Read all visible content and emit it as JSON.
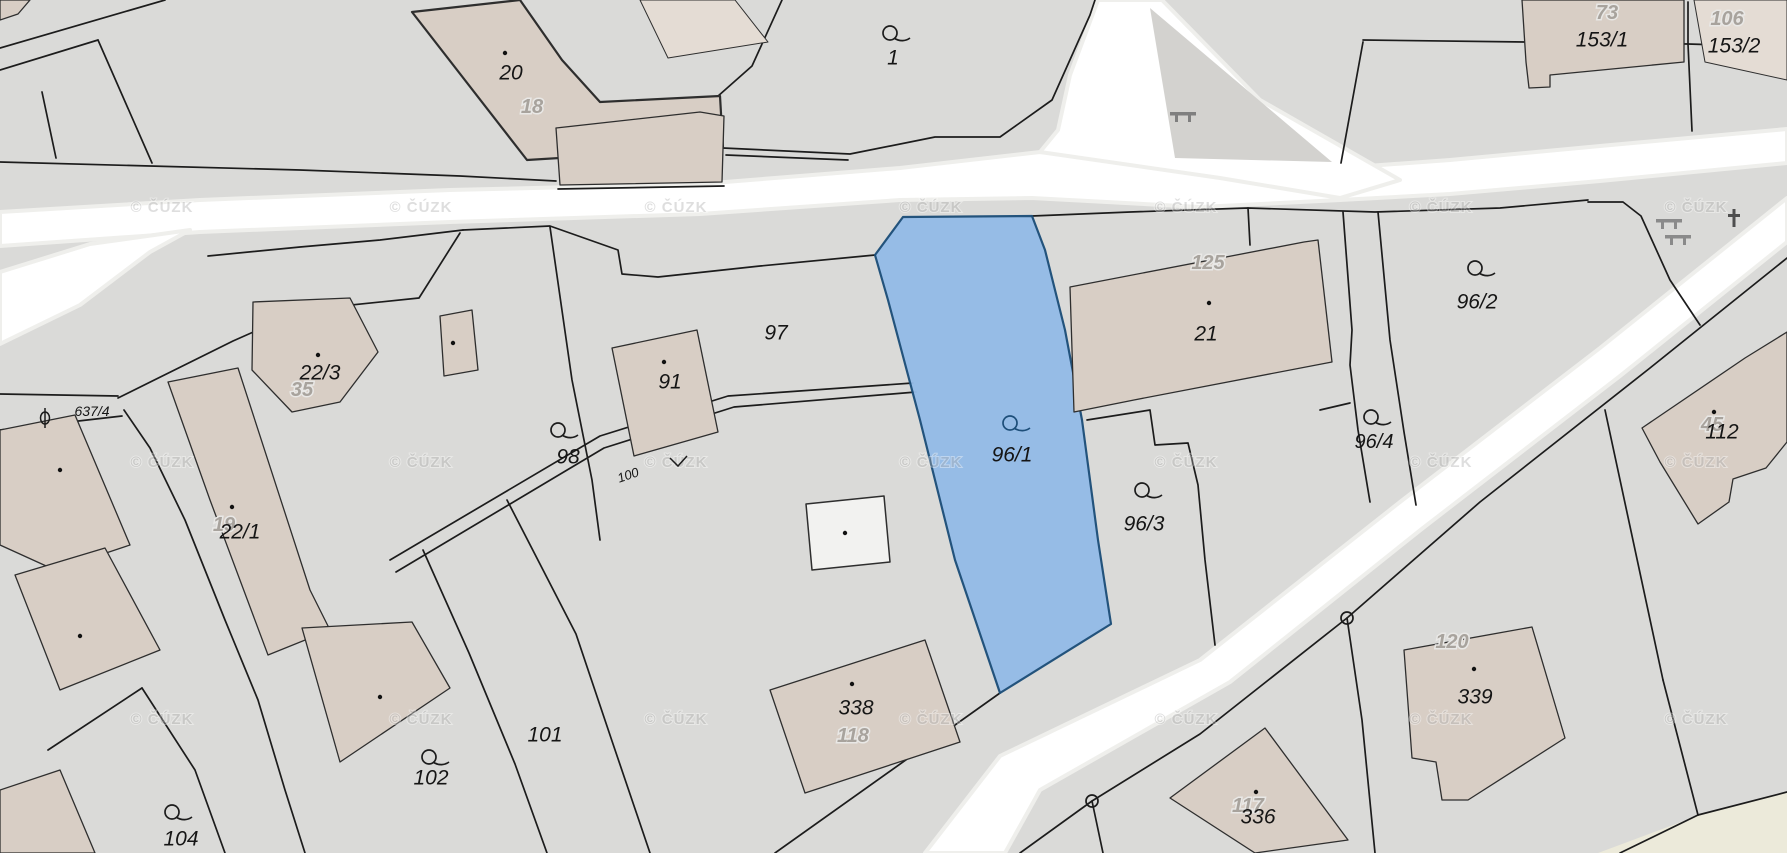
{
  "map": {
    "source_watermark": {
      "text": "© ČÚZK",
      "columns": [
        162,
        421,
        676,
        931,
        1186,
        1441,
        1696
      ],
      "rows": [
        212,
        467,
        724
      ]
    },
    "highlight": {
      "parcel": "96/1",
      "fill": "#94bbe7",
      "border": "#1c4e79",
      "label_color": "#1d4e79"
    },
    "colors": {
      "background": "#dadad8",
      "road": "#ffffff",
      "building": "#d8cec5",
      "building_light": "#e4dcd4",
      "field_yellow": "#eceada",
      "boundary": "#1c1c1c",
      "island_gray": "#d3d2cf"
    },
    "parcel_labels": [
      {
        "text": "20",
        "x": 511,
        "y": 73,
        "size": 21
      },
      {
        "text": "1",
        "x": 893,
        "y": 58,
        "size": 21
      },
      {
        "text": "153/1",
        "x": 1602,
        "y": 40,
        "size": 21
      },
      {
        "text": "153/2",
        "x": 1734,
        "y": 46,
        "size": 21
      },
      {
        "text": "96/2",
        "x": 1477,
        "y": 302,
        "size": 21
      },
      {
        "text": "21",
        "x": 1206,
        "y": 334,
        "size": 21
      },
      {
        "text": "97",
        "x": 776,
        "y": 333,
        "size": 21
      },
      {
        "text": "91",
        "x": 670,
        "y": 382,
        "size": 21
      },
      {
        "text": "98",
        "x": 568,
        "y": 457,
        "size": 21
      },
      {
        "text": "22/3",
        "x": 320,
        "y": 373,
        "size": 21
      },
      {
        "text": "22/1",
        "x": 240,
        "y": 532,
        "size": 21
      },
      {
        "text": "96/1",
        "x": 1012,
        "y": 455,
        "size": 21,
        "color": "#1d4e79"
      },
      {
        "text": "96/3",
        "x": 1144,
        "y": 524,
        "size": 21
      },
      {
        "text": "96/4",
        "x": 1374,
        "y": 442,
        "size": 20
      },
      {
        "text": "112",
        "x": 1722,
        "y": 432,
        "size": 21
      },
      {
        "text": "101",
        "x": 545,
        "y": 735,
        "size": 21
      },
      {
        "text": "102",
        "x": 431,
        "y": 778,
        "size": 21
      },
      {
        "text": "104",
        "x": 181,
        "y": 839,
        "size": 21
      },
      {
        "text": "338",
        "x": 856,
        "y": 708,
        "size": 21
      },
      {
        "text": "336",
        "x": 1258,
        "y": 817,
        "size": 21
      },
      {
        "text": "339",
        "x": 1475,
        "y": 697,
        "size": 21
      },
      {
        "text": "637/4",
        "x": 92,
        "y": 411,
        "size": 14
      },
      {
        "text": "100",
        "x": 628,
        "y": 475,
        "size": 13,
        "rotate": -19
      }
    ],
    "building_numbers": [
      {
        "text": "18",
        "x": 532,
        "y": 107
      },
      {
        "text": "73",
        "x": 1607,
        "y": 13
      },
      {
        "text": "106",
        "x": 1727,
        "y": 19
      },
      {
        "text": "125",
        "x": 1208,
        "y": 263
      },
      {
        "text": "35",
        "x": 302,
        "y": 390
      },
      {
        "text": "19",
        "x": 224,
        "y": 525
      },
      {
        "text": "45",
        "x": 1712,
        "y": 425
      },
      {
        "text": "118",
        "x": 853,
        "y": 736
      },
      {
        "text": "117",
        "x": 1248,
        "y": 806
      },
      {
        "text": "120",
        "x": 1452,
        "y": 642
      }
    ],
    "symbols": [
      {
        "type": "landuse",
        "name": "landuse-icon-parcel-1",
        "x": 890,
        "y": 33,
        "color": "#1c1c1c"
      },
      {
        "type": "landuse",
        "name": "landuse-icon-parcel-98",
        "x": 558,
        "y": 430,
        "color": "#1c1c1c"
      },
      {
        "type": "landuse",
        "name": "landuse-icon-parcel-96-2",
        "x": 1475,
        "y": 268,
        "color": "#1c1c1c"
      },
      {
        "type": "landuse",
        "name": "landuse-icon-parcel-96-1",
        "x": 1010,
        "y": 423,
        "color": "#1d4e79"
      },
      {
        "type": "landuse",
        "name": "landuse-icon-parcel-96-3",
        "x": 1142,
        "y": 490,
        "color": "#1c1c1c"
      },
      {
        "type": "landuse",
        "name": "landuse-icon-parcel-96-4",
        "x": 1371,
        "y": 417,
        "color": "#1c1c1c"
      },
      {
        "type": "landuse",
        "name": "landuse-icon-parcel-102",
        "x": 429,
        "y": 757,
        "color": "#1c1c1c"
      },
      {
        "type": "landuse",
        "name": "landuse-icon-parcel-104",
        "x": 172,
        "y": 812,
        "color": "#1c1c1c"
      },
      {
        "type": "theta",
        "name": "road-parcel-icon-637-4",
        "x": 45,
        "y": 418,
        "color": "#1c1c1c"
      },
      {
        "type": "tick",
        "name": "path-tick-icon",
        "x": 678,
        "y": 462,
        "color": "#1c1c1c"
      },
      {
        "type": "bench",
        "name": "bench-icon-junction",
        "x": 1183,
        "y": 114,
        "color": "#7f7f7f"
      },
      {
        "type": "bench",
        "name": "bench-icon-wedge-1",
        "x": 1669,
        "y": 221,
        "color": "#8a8a8a"
      },
      {
        "type": "bench",
        "name": "bench-icon-wedge-2",
        "x": 1678,
        "y": 237,
        "color": "#8a8a8a"
      },
      {
        "type": "cross",
        "name": "cross-icon-wedge",
        "x": 1734,
        "y": 218,
        "color": "#4e4e4e"
      }
    ]
  }
}
